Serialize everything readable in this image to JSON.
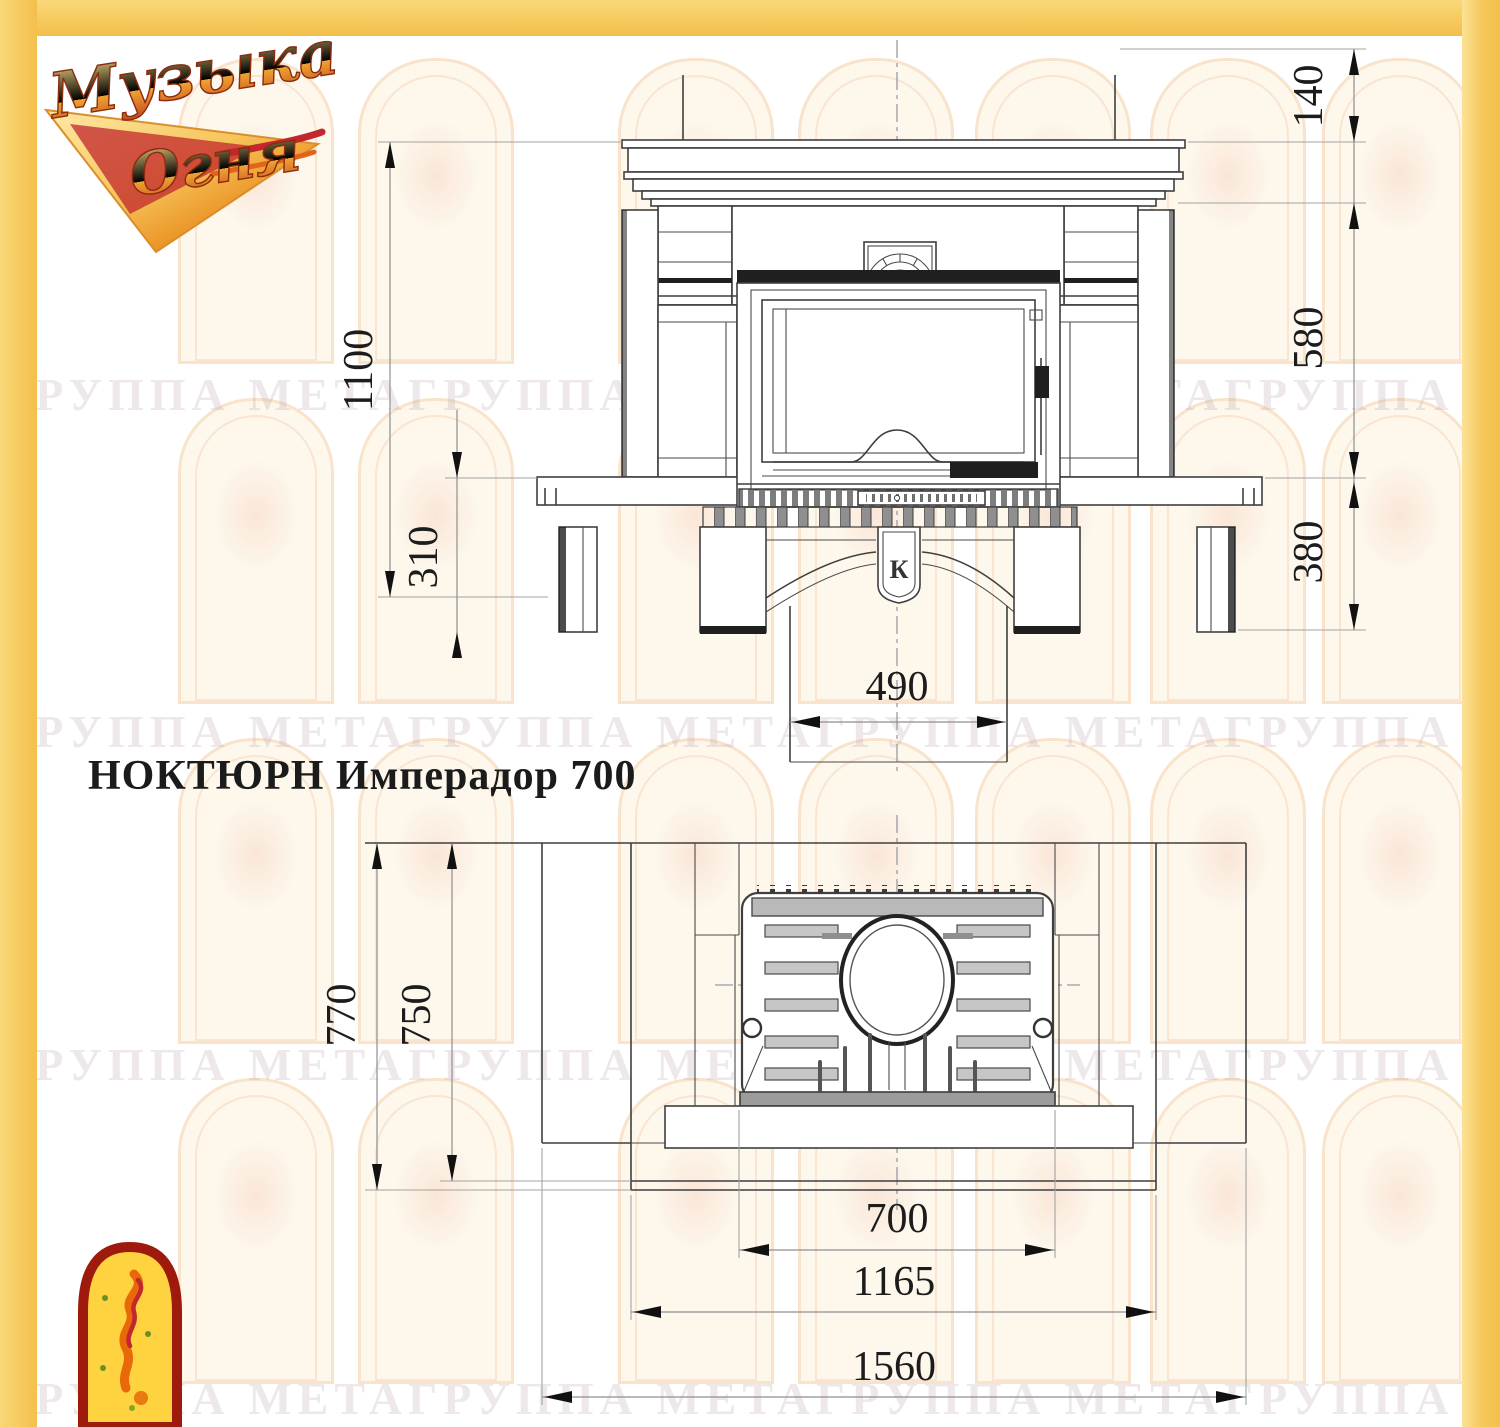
{
  "title": "НОКТЮРН Имперадор 700",
  "logo": {
    "word1": "Музыка",
    "word2": "Огня"
  },
  "watermark": {
    "row": "ГРУППА МЕТАГРУППА МЕТАГРУППА МЕТАГРУППА МЕТА"
  },
  "front_view": {
    "dims": {
      "total_height": "1100",
      "hearth_height": "310",
      "top_height": "140",
      "opening_height": "580",
      "base_height": "380",
      "pedestal_width": "490"
    },
    "keystone_mark": "К"
  },
  "plan_view": {
    "dims": {
      "depth_outer": "770",
      "depth_inner": "750",
      "firebox_width": "700",
      "portal_width": "1165",
      "total_width": "1560"
    }
  },
  "colors": {
    "border_yellow": "#f6c95c",
    "line_dark": "#3f3f3f",
    "logo_red": "#c1272d",
    "logo_gold": "#f5a623"
  }
}
